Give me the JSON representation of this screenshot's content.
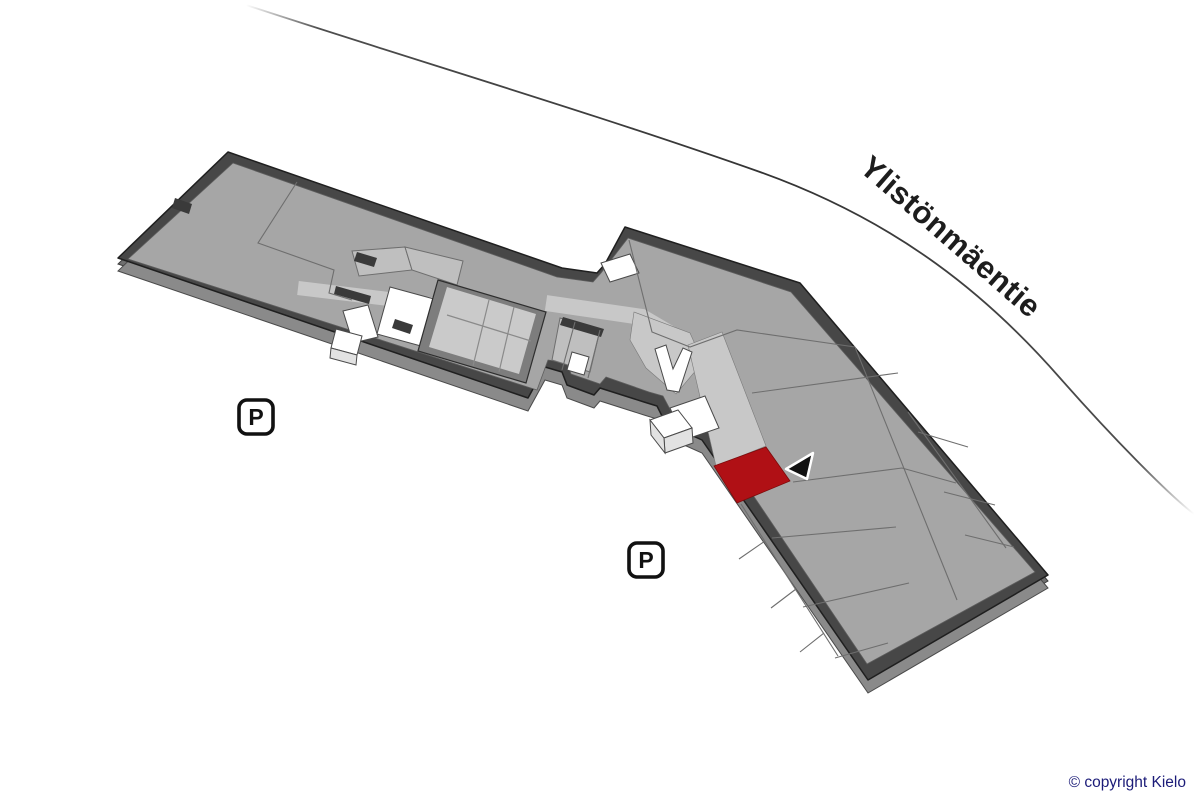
{
  "map": {
    "road_label": "Ylistönmäentie",
    "markers": {
      "parking_label": "P"
    },
    "highlight_room": {
      "label": "highlighted unit"
    }
  },
  "footer": {
    "copyright": "© copyright Kielo"
  },
  "colors": {
    "highlight": "#b01015",
    "copyright_text": "#1b1b78",
    "road_label_text": "#1d1d1d",
    "wall": "#474747",
    "floor": "#a6a6a6",
    "corridor": "#c8c8c8"
  }
}
